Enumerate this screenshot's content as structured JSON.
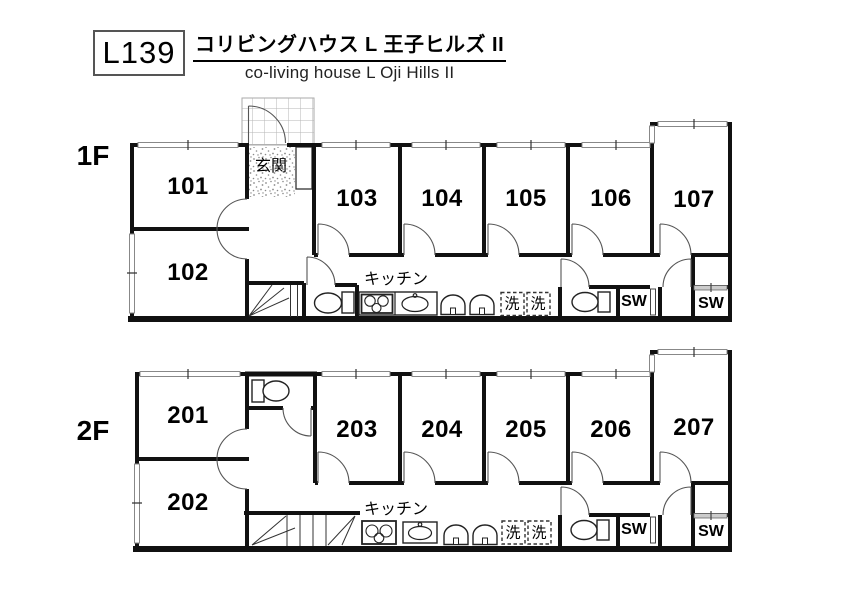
{
  "header": {
    "plan_code": "L139",
    "title_ja": "コリビングハウス L 王子ヒルズ II",
    "title_en": "co-living house L Oji Hills II"
  },
  "labels": {
    "entrance": "玄関",
    "kitchen": "キッチン",
    "laundry": "洗",
    "shower_room": "SW"
  },
  "floor1": {
    "label": "1F",
    "rooms": {
      "r101": "101",
      "r102": "102",
      "r103": "103",
      "r104": "104",
      "r105": "105",
      "r106": "106",
      "r107": "107"
    }
  },
  "floor2": {
    "label": "2F",
    "rooms": {
      "r201": "201",
      "r202": "202",
      "r203": "203",
      "r204": "204",
      "r205": "205",
      "r206": "206",
      "r207": "207"
    }
  }
}
